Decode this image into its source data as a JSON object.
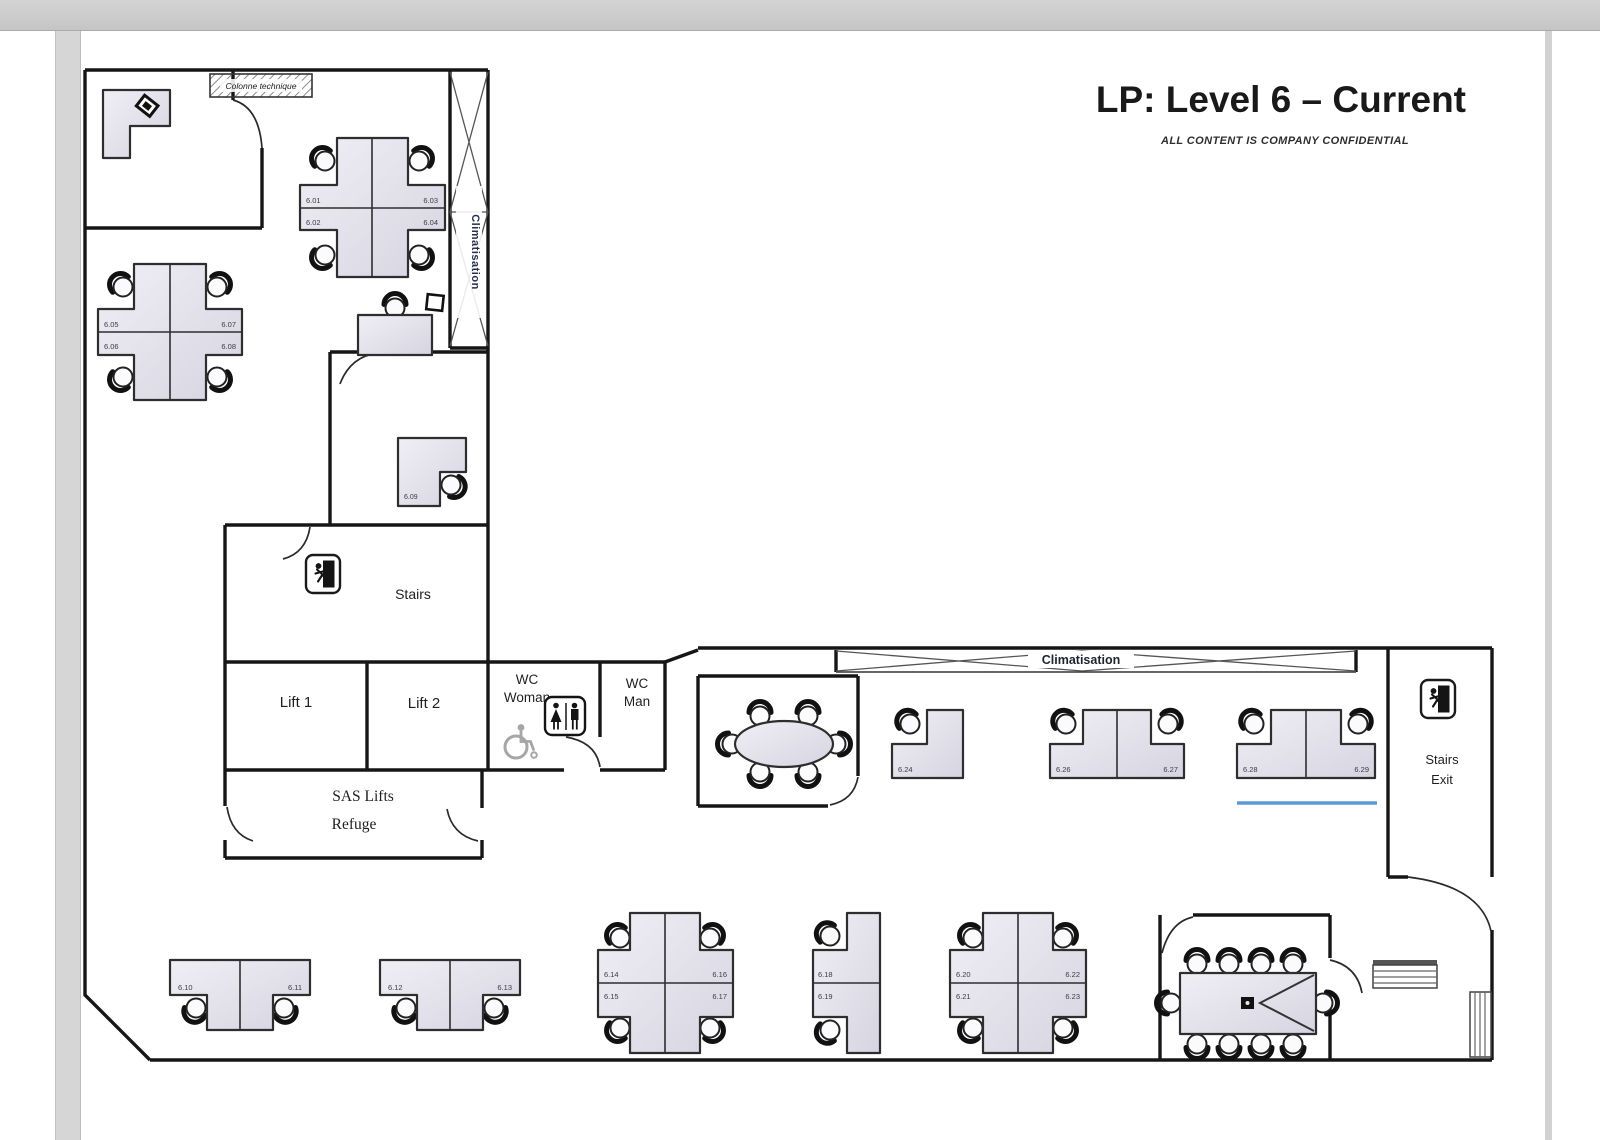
{
  "title": "LP: Level 6 – Current",
  "subtitle": "ALL CONTENT IS COMPANY CONFIDENTIAL",
  "rooms": {
    "colonne_technique": "Colonne technique",
    "climatisation_column": "Climatisation",
    "climatisation_band": "Climatisation",
    "stairs": "Stairs",
    "lift1": "Lift 1",
    "lift2": "Lift 2",
    "wc_woman_l1": "WC",
    "wc_woman_l2": "Woman",
    "wc_man_l1": "WC",
    "wc_man_l2": "Man",
    "sas_lifts": "SAS Lifts",
    "refuge": "Refuge",
    "stairs_exit_l1": "Stairs",
    "stairs_exit_l2": "Exit"
  },
  "desks": {
    "d601": "6.01",
    "d602": "6.02",
    "d603": "6.03",
    "d604": "6.04",
    "d605": "6.05",
    "d606": "6.06",
    "d607": "6.07",
    "d608": "6.08",
    "d609": "6.09",
    "d610": "6.10",
    "d611": "6.11",
    "d612": "6.12",
    "d613": "6.13",
    "d614": "6.14",
    "d615": "6.15",
    "d616": "6.16",
    "d617": "6.17",
    "d618": "6.18",
    "d619": "6.19",
    "d620": "6.20",
    "d621": "6.21",
    "d622": "6.22",
    "d623": "6.23",
    "d624": "6.24",
    "d626": "6.26",
    "d627": "6.27",
    "d628": "6.28",
    "d629": "6.29"
  },
  "colors": {
    "accent_blue": "#5b9bd5",
    "desk_fill": "#e2e0ea",
    "wall": "#161616"
  }
}
